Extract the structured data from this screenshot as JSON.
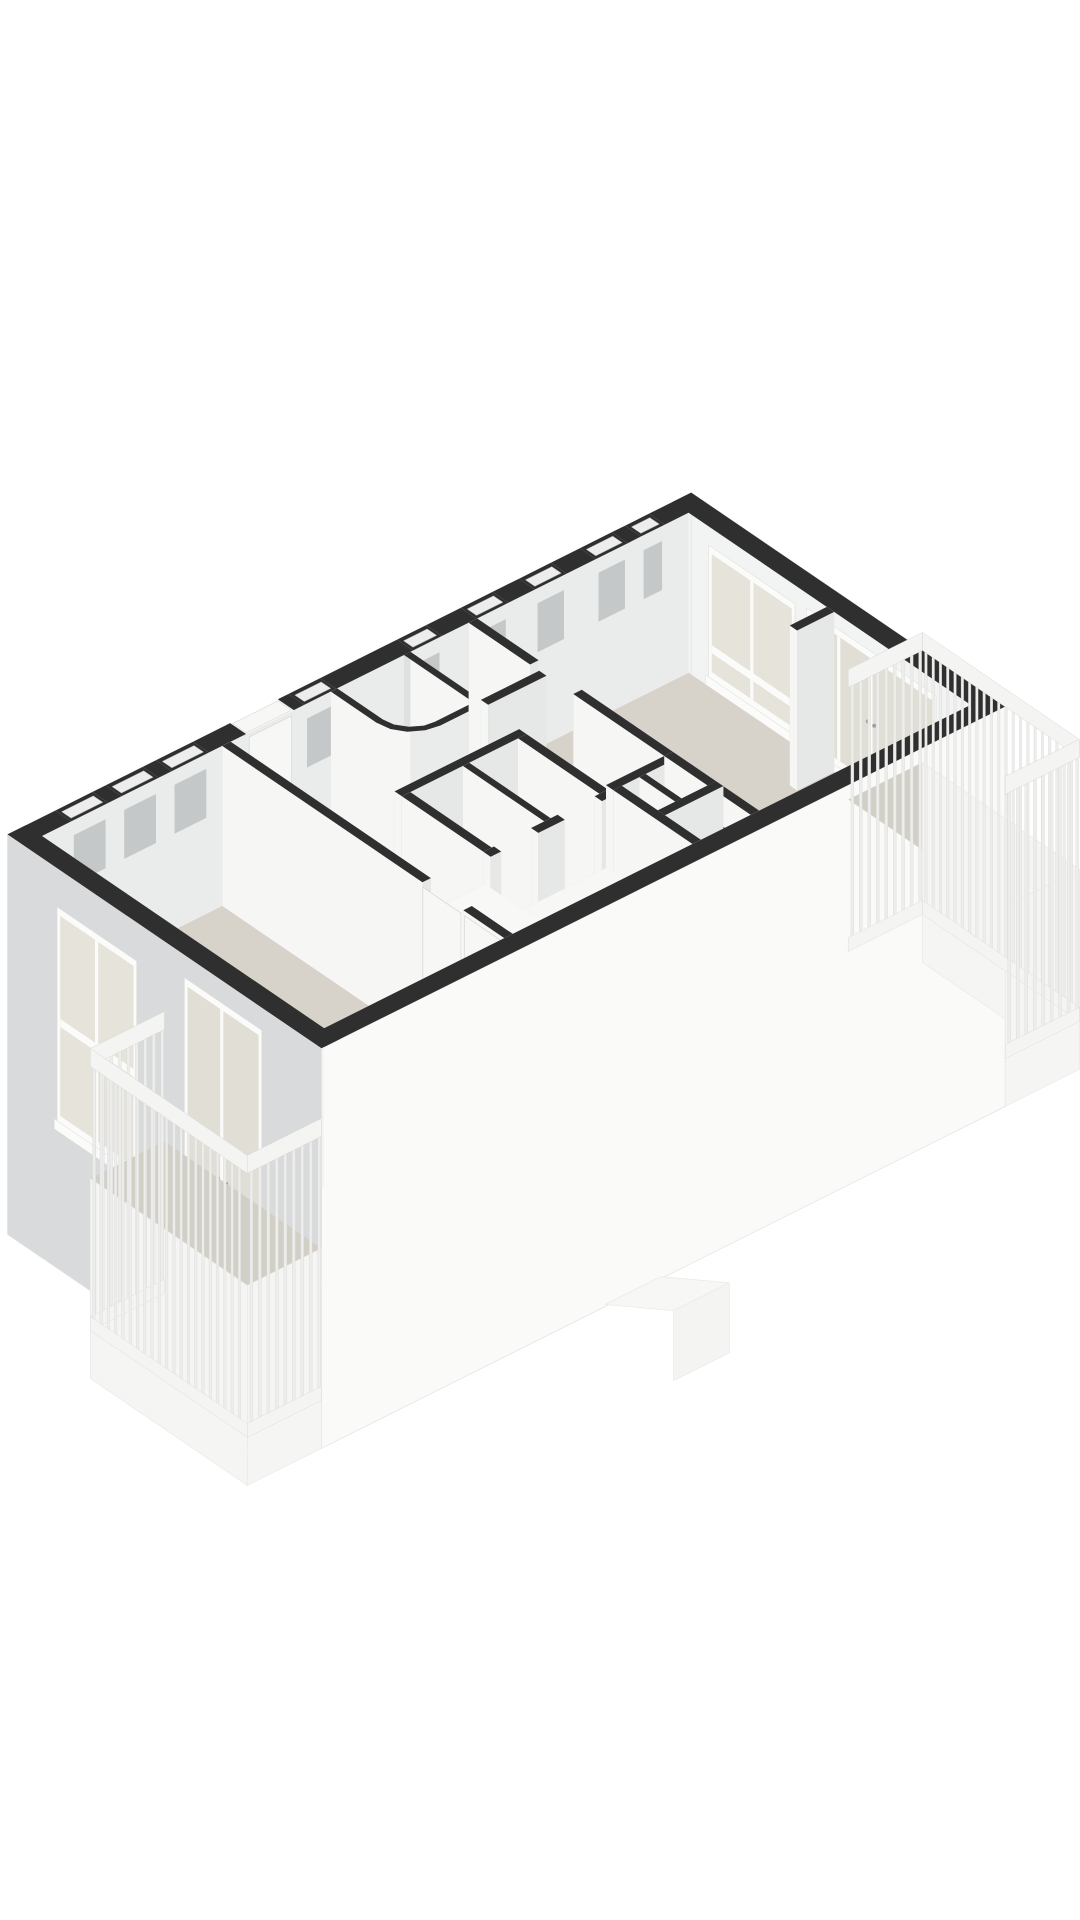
{
  "page": {
    "background": "#ffffff"
  },
  "palette": {
    "wallTop": "#2f2f30",
    "floor": "#d7d3ca",
    "balconyFloor": "#d2cfc7",
    "inMinusU": "#f6f6f5",
    "inPlusU": "#efefee",
    "inPlusV": "#e6e8e7",
    "inMinusV": "#c8cbcc",
    "nwInner": "#eaecec",
    "neInner": "#f1f2f1",
    "seInner": "#c8cbcc",
    "swInner": "#f4f4f3",
    "wcInner": "#dfe1e0",
    "facadeSE": "#fafaf9",
    "facadeSW": "#d8dadb",
    "facadeNE": "#f2f3f3",
    "frame": "#fbfbfa",
    "glass": "#e6e3db",
    "glassDoor": "#e1ded6",
    "slit": "#ecedec",
    "slitEdge": "#98989b",
    "recess": "#c5c8c9",
    "doorPanel": "#f7f7f6",
    "doorEdge": "#d6d6d4",
    "handle": "#9ea2a4",
    "seam": "#dadad8",
    "fixture": "#f5f5f3",
    "fixtureEdge": "#bfbfbc",
    "fixtureInner": "#ebebe9",
    "fixtureShadow": "#d2d2cf",
    "railTop": "#f4f4f3",
    "railSlat": "#ededec",
    "railEdge": "#d8d8d6",
    "fascia": "#f5f5f4",
    "ghost": "#f7f7f6",
    "ghostEdge": "#ebebe9"
  },
  "proj": {
    "au": [
      53,
      -26.5
    ],
    "av": [
      45.5,
      31
    ],
    "origin": [
      42,
      836
    ],
    "floor_z": 160,
    "facade_z": 400
  },
  "scene": [
    {
      "name": "nw-exterior-wall",
      "t": "xwall",
      "dir": "u",
      "at": 0,
      "sign": -1,
      "th": 0.35,
      "s": [
        -0.35,
        12.55
      ],
      "inS": [
        0,
        12.2
      ],
      "hIn": 160,
      "fIn": "nwInner",
      "hOut": 0,
      "gaps": [
        {
          "k": "slit",
          "s": [
            0.55,
            1.25
          ]
        },
        {
          "k": "slit",
          "s": [
            1.5,
            2.2
          ]
        },
        {
          "k": "slit",
          "s": [
            2.45,
            3.15
          ]
        },
        {
          "k": "door",
          "s": [
            3.85,
            4.75
          ]
        },
        {
          "k": "slit",
          "s": [
            4.95,
            5.55
          ]
        },
        {
          "k": "slit",
          "s": [
            7.0,
            7.55
          ]
        },
        {
          "k": "slit",
          "s": [
            8.2,
            8.8
          ]
        },
        {
          "k": "slit",
          "s": [
            9.3,
            9.9
          ]
        },
        {
          "k": "slit",
          "s": [
            10.45,
            11.05
          ]
        },
        {
          "k": "slit",
          "s": [
            11.3,
            11.75
          ]
        }
      ]
    },
    {
      "name": "nw-clerestory-recesses",
      "t": "recesses",
      "list": [
        [
          0.55,
          1.25
        ],
        [
          1.5,
          2.2
        ],
        [
          2.45,
          3.15
        ],
        [
          4.95,
          5.55
        ],
        [
          7.0,
          7.55
        ],
        [
          8.2,
          8.8
        ],
        [
          9.3,
          9.9
        ],
        [
          10.45,
          11.05
        ],
        [
          11.3,
          11.75
        ]
      ],
      "z": [
        15,
        64
      ]
    },
    {
      "name": "entrance-door-panel",
      "t": "face",
      "dir": "u",
      "at": 0.01,
      "s": [
        3.9,
        4.7
      ],
      "z": [
        4,
        158
      ],
      "fill": "doorPanel",
      "stroke": "doorEdge",
      "sw": 0.7
    },
    {
      "name": "entrance-door-handle",
      "t": "dot",
      "u": 4.56,
      "v": 0.01,
      "z": 85
    },
    {
      "name": "ne-exterior-wall",
      "t": "xwall",
      "dir": "v",
      "at": 12.2,
      "sign": 1,
      "th": 0.35,
      "s": [
        -0.35,
        6.55
      ],
      "inS": [
        0,
        6.2
      ],
      "hIn": 160,
      "fIn": "neInner",
      "hOut": 400,
      "fOut": "facadeNE"
    },
    {
      "name": "living-window",
      "t": "win",
      "dir": "v",
      "at": 12.19,
      "s1": 0.45,
      "s2": 2.35,
      "z1": 18,
      "z2": 150,
      "mull": [
        1.4
      ],
      "rails": [
        [
          116,
          124
        ]
      ],
      "sill": [
        150,
        160
      ]
    },
    {
      "name": "living-balcony-doors",
      "t": "win",
      "dir": "v",
      "at": 12.19,
      "s1": 2.6,
      "s2": 5.45,
      "z1": 14,
      "z2": 152,
      "glass": "glassDoor",
      "mull": [
        3.31,
        4.02,
        4.73
      ],
      "handles": [
        [
          3.95,
          86
        ],
        [
          4.09,
          86
        ]
      ],
      "sill": [
        152,
        160
      ]
    },
    {
      "name": "apartment-floor",
      "t": "flat",
      "pts": [
        [
          0,
          0
        ],
        [
          12.2,
          0
        ],
        [
          12.2,
          6.2
        ],
        [
          0,
          6.2
        ]
      ],
      "z": 160,
      "fill": "floor"
    },
    {
      "name": "wc-basin-shadow",
      "t": "ell",
      "u": 6.38,
      "v": 0.54,
      "z": 156,
      "r": 0.19,
      "fill": "fixtureShadow"
    },
    {
      "name": "wc-basin",
      "t": "ell",
      "u": 6.36,
      "v": 0.5,
      "z": 148,
      "r": 0.16,
      "fill": "fixture",
      "stroke": "fixtureEdge",
      "sw": 0.8
    },
    {
      "name": "wc-basin-tap",
      "t": "seg",
      "a": [
        6.5,
        0.3,
        118
      ],
      "b": [
        6.4,
        0.44,
        126
      ],
      "w": 1.6,
      "col": "#b4b8ba"
    },
    {
      "name": "wc-inner-walls",
      "t": "ribbon",
      "pts": [
        [
          5.57,
          0
        ],
        [
          5.57,
          1.0
        ],
        [
          5.61,
          1.2
        ],
        [
          5.74,
          1.38
        ],
        [
          5.92,
          1.5
        ],
        [
          6.1,
          1.53
        ],
        [
          6.83,
          1.53
        ],
        [
          6.83,
          0
        ]
      ],
      "z": [
        0,
        160
      ],
      "fill": "wcInner"
    },
    {
      "name": "wc-outer-walls",
      "t": "ribbon",
      "pts": [
        [
          5.45,
          0
        ],
        [
          5.45,
          1.0
        ],
        [
          5.5,
          1.25
        ],
        [
          5.64,
          1.46
        ],
        [
          5.86,
          1.6
        ],
        [
          6.1,
          1.65
        ],
        [
          6.95,
          1.65
        ],
        [
          6.95,
          0
        ]
      ],
      "z": [
        0,
        160
      ],
      "fill": "inMinusU"
    },
    {
      "name": "wc-wall-top",
      "t": "ribbonTop",
      "outer": [
        [
          5.45,
          0
        ],
        [
          5.45,
          1.0
        ],
        [
          5.5,
          1.25
        ],
        [
          5.64,
          1.46
        ],
        [
          5.86,
          1.6
        ],
        [
          6.1,
          1.65
        ],
        [
          6.95,
          1.65
        ],
        [
          6.95,
          0
        ]
      ],
      "inner": [
        [
          5.57,
          0
        ],
        [
          5.57,
          1.0
        ],
        [
          5.61,
          1.2
        ],
        [
          5.74,
          1.38
        ],
        [
          5.92,
          1.5
        ],
        [
          6.1,
          1.53
        ],
        [
          6.83,
          1.53
        ],
        [
          6.83,
          0
        ]
      ],
      "fill": "wallTop"
    },
    {
      "name": "living-wall-upper",
      "t": "box",
      "u1": 8.05,
      "u2": 8.21,
      "v1": 0,
      "v2": 1.35
    },
    {
      "name": "living-wall-mid",
      "t": "box",
      "u1": 8.05,
      "u2": 8.21,
      "v1": 2.3,
      "v2": 4.3
    },
    {
      "name": "corridor-north-wall",
      "t": "box",
      "u1": 6.95,
      "u2": 8.05,
      "v1": 1.55,
      "v2": 1.71
    },
    {
      "name": "bathroom-back-wall",
      "t": "box",
      "u1": 4.55,
      "u2": 6.9,
      "v1": 2.45,
      "v2": 2.61
    },
    {
      "name": "bathroom-right-wall",
      "t": "box",
      "u1": 6.74,
      "u2": 6.9,
      "v1": 2.61,
      "v2": 4.4
    },
    {
      "name": "toilet2-shadow",
      "t": "ell",
      "u": 6.32,
      "v": 3.26,
      "z": 156,
      "r": 0.25,
      "fill": "fixtureShadow"
    },
    {
      "name": "toilet2-cistern",
      "t": "box",
      "u1": 6.14,
      "u2": 6.46,
      "v1": 2.62,
      "v2": 2.86,
      "z1": 100,
      "ftop": "#f0f0ee",
      "fmu": "#fbfbfa",
      "fpv": "#ededeb"
    },
    {
      "name": "toilet2-bowl",
      "t": "ell",
      "u": 6.3,
      "v": 3.2,
      "z": 146,
      "r": 0.21,
      "fill": "fixture",
      "stroke": "fixtureEdge",
      "sw": 0.8
    },
    {
      "name": "toilet2-seat",
      "t": "ell",
      "u": 6.28,
      "v": 3.16,
      "z": 144,
      "r": 0.12,
      "fill": "fixtureInner",
      "stroke": "#d6d6d3",
      "sw": 0.5
    },
    {
      "name": "bathroom-partition",
      "t": "box",
      "u1": 5.7,
      "u2": 5.82,
      "v1": 2.61,
      "v2": 4.4
    },
    {
      "name": "toilet1-shadow",
      "t": "ell",
      "u": 5.18,
      "v": 3.26,
      "z": 156,
      "r": 0.25,
      "fill": "fixtureShadow"
    },
    {
      "name": "toilet1-cistern",
      "t": "box",
      "u1": 4.98,
      "u2": 5.3,
      "v1": 2.62,
      "v2": 2.86,
      "z1": 100,
      "ftop": "#f0f0ee",
      "fmu": "#fbfbfa",
      "fpv": "#ededeb"
    },
    {
      "name": "toilet1-bowl",
      "t": "ell",
      "u": 5.16,
      "v": 3.2,
      "z": 146,
      "r": 0.21,
      "fill": "fixture",
      "stroke": "fixtureEdge",
      "sw": 0.8
    },
    {
      "name": "toilet1-seat",
      "t": "ell",
      "u": 5.14,
      "v": 3.16,
      "z": 144,
      "r": 0.12,
      "fill": "fixtureInner",
      "stroke": "#d6d6d3",
      "sw": 0.5
    },
    {
      "name": "bathroom-left-wall",
      "t": "box",
      "u1": 4.55,
      "u2": 4.71,
      "v1": 2.61,
      "v2": 4.4
    },
    {
      "name": "bathroom-front-wall-a",
      "t": "box",
      "u1": 4.55,
      "u2": 4.75,
      "v1": 4.4,
      "v2": 4.56
    },
    {
      "name": "bathroom-front-wall-b",
      "t": "box",
      "u1": 5.45,
      "u2": 5.95,
      "v1": 4.4,
      "v2": 4.56
    },
    {
      "name": "bathroom-front-wall-c",
      "t": "box",
      "u1": 6.65,
      "u2": 6.9,
      "v1": 4.4,
      "v2": 4.56
    },
    {
      "name": "storage-back-wall",
      "t": "box",
      "u1": 6.95,
      "u2": 8.05,
      "v1": 4.3,
      "v2": 4.46
    },
    {
      "name": "storage-right-wall",
      "t": "box",
      "u1": 8.05,
      "u2": 8.21,
      "v1": 4.3,
      "v2": 6.2
    },
    {
      "name": "storage-mid-wall-u",
      "t": "box",
      "u1": 7.44,
      "u2": 7.56,
      "v1": 4.46,
      "v2": 6.2
    },
    {
      "name": "storage-mid-wall-v",
      "t": "box",
      "u1": 6.95,
      "u2": 8.21,
      "v1": 5.25,
      "v2": 5.41
    },
    {
      "name": "storage-left-wall",
      "t": "box",
      "u1": 6.95,
      "u2": 7.11,
      "v1": 4.46,
      "v2": 6.2
    },
    {
      "name": "hall-low-cabinet",
      "t": "box",
      "u1": 4.6,
      "u2": 6.8,
      "v1": 4.5,
      "v2": 5.08,
      "z1": 72,
      "ftop": "#f7f7f6",
      "fmu": "#f4f4f2",
      "fpv": "#f1f1ef",
      "seamsV": [
        5.15,
        5.7,
        6.25
      ]
    },
    {
      "name": "wardrobe",
      "t": "box",
      "u1": 3.62,
      "u2": 4.5,
      "v1": 4.5,
      "v2": 6.05,
      "z1": 28,
      "ftop": "#f8f8f7",
      "fmu": "#fafaf8",
      "fpv": "#ebedec",
      "seamsU": [
        5.27
      ],
      "handles": [
        {
          "f": "mu",
          "s": 5.2,
          "z": 88
        },
        {
          "f": "mu",
          "s": 5.35,
          "z": 88
        }
      ]
    },
    {
      "name": "bedroom-wall-upper",
      "t": "box",
      "u1": 3.4,
      "u2": 3.56,
      "v1": 0,
      "v2": 4.4
    },
    {
      "name": "bedroom-door",
      "t": "face",
      "dir": "v",
      "at": 3.39,
      "s": [
        4.42,
        5.26
      ],
      "z": [
        4,
        158
      ],
      "fill": "doorPanel",
      "stroke": "doorEdge",
      "sw": 0.7
    },
    {
      "name": "bedroom-door-handle",
      "t": "dot",
      "u": 3.39,
      "v": 5.12,
      "z": 88
    },
    {
      "name": "bedroom-wall-lower",
      "t": "box",
      "u1": 3.4,
      "u2": 3.56,
      "v1": 5.3,
      "v2": 6.2
    },
    {
      "name": "closet-door",
      "t": "face",
      "dir": "v",
      "at": 3.39,
      "s": [
        5.34,
        6.14
      ],
      "z": [
        4,
        158
      ],
      "fill": "doorPanel",
      "stroke": "doorEdge",
      "sw": 0.7
    },
    {
      "name": "closet-door-handle",
      "t": "dot",
      "u": 3.39,
      "v": 5.48,
      "z": 88
    },
    {
      "name": "living-stub-wall",
      "t": "box",
      "u1": 11.5,
      "u2": 12.2,
      "v1": 3.04,
      "v2": 3.2
    },
    {
      "name": "se-exterior-wall",
      "t": "xwall",
      "dir": "u",
      "at": 6.2,
      "sign": 1,
      "th": 0.35,
      "s": [
        -0.35,
        12.55
      ],
      "inS": [
        0,
        12.2
      ],
      "hIn": 160,
      "fIn": "seInner",
      "hOut": 400,
      "fOut": "facadeSE"
    },
    {
      "name": "sw-exterior-wall",
      "t": "xwall",
      "dir": "v",
      "at": 0,
      "sign": -1,
      "th": 0.35,
      "s": [
        -0.35,
        6.55
      ],
      "inS": [
        0,
        6.2
      ],
      "hIn": 160,
      "fIn": "swInner",
      "hOut": 400,
      "fOut": "facadeSW"
    },
    {
      "name": "bedroom-window",
      "t": "win",
      "dir": "v",
      "at": -0.36,
      "s1": 0.75,
      "s2": 2.5,
      "z1": 38,
      "z2": 252,
      "mull": [
        1.62
      ],
      "rails": [
        [
          148,
          156
        ]
      ],
      "sill": [
        252,
        262
      ]
    },
    {
      "name": "bedroom-balcony-doors",
      "t": "win",
      "dir": "v",
      "at": -0.36,
      "s1": 3.55,
      "s2": 5.25,
      "z1": 22,
      "z2": 385,
      "glass": "glassDoor",
      "mull": [
        4.37
      ],
      "handles": [
        [
          4.28,
          200
        ],
        [
          4.47,
          200
        ]
      ],
      "sill": [
        370,
        385
      ]
    },
    {
      "name": "lower-level-ghost-top",
      "t": "p3",
      "pts": [
        [
          5.0,
          6.55,
          398
        ],
        [
          6.05,
          6.55,
          398
        ],
        [
          6.7,
          7.3,
          398
        ],
        [
          5.65,
          7.3,
          398
        ]
      ],
      "fill": "ghost",
      "stroke": "ghostEdge",
      "sw": 0.8
    },
    {
      "name": "lower-level-ghost-face",
      "t": "p3",
      "pts": [
        [
          5.65,
          7.3,
          398
        ],
        [
          6.7,
          7.3,
          398
        ],
        [
          6.7,
          7.3,
          468
        ],
        [
          5.65,
          7.3,
          468
        ]
      ],
      "fill": "#f4f4f3",
      "stroke": "ghostEdge",
      "sw": 0.8
    },
    {
      "name": "south-balcony-floor",
      "t": "flat",
      "pts": [
        [
          -1.75,
          3.1
        ],
        [
          -0.35,
          3.1
        ],
        [
          -0.35,
          6.55
        ],
        [
          -1.75,
          6.55
        ]
      ],
      "z": 200,
      "fill": "balconyFloor"
    },
    {
      "name": "south-balcony-fascia-sw",
      "t": "face",
      "dir": "v",
      "at": -1.75,
      "s": [
        3.1,
        6.55
      ],
      "z": [
        200,
        400
      ],
      "fill": "fascia",
      "stroke": "#e7e7e5",
      "sw": 0.6
    },
    {
      "name": "south-balcony-fascia-se",
      "t": "face",
      "dir": "u",
      "at": 6.55,
      "s": [
        -1.75,
        -0.35
      ],
      "z": [
        200,
        400
      ],
      "fill": "fascia",
      "stroke": "#e7e7e5",
      "sw": 0.6
    },
    {
      "name": "south-balcony-rail-nw",
      "t": "fence",
      "dir": "u",
      "at": 3.1,
      "s1": -1.75,
      "s2": -0.35
    },
    {
      "name": "south-balcony-rail-sw",
      "t": "fence",
      "dir": "v",
      "at": -1.75,
      "s1": 3.1,
      "s2": 6.55
    },
    {
      "name": "south-balcony-rail-se",
      "t": "fence",
      "dir": "u",
      "at": 6.55,
      "s1": -1.75,
      "s2": -0.35
    },
    {
      "name": "east-balcony-floor",
      "t": "flat",
      "pts": [
        [
          12.55,
          3.1
        ],
        [
          13.95,
          3.1
        ],
        [
          13.95,
          6.55
        ],
        [
          12.55,
          6.55
        ]
      ],
      "z": 200,
      "fill": "balconyFloor"
    },
    {
      "name": "east-balcony-fascia-ne",
      "t": "face",
      "dir": "v",
      "at": 13.95,
      "s": [
        3.1,
        6.55
      ],
      "z": [
        200,
        400
      ],
      "fill": "fascia",
      "stroke": "#e7e7e5",
      "sw": 0.6
    },
    {
      "name": "east-balcony-fascia-se",
      "t": "face",
      "dir": "u",
      "at": 6.55,
      "s": [
        12.55,
        13.95
      ],
      "z": [
        200,
        400
      ],
      "fill": "fascia",
      "stroke": "#e7e7e5",
      "sw": 0.6
    },
    {
      "name": "east-balcony-rail-nw",
      "t": "fence",
      "dir": "u",
      "at": 3.1,
      "s1": 12.55,
      "s2": 13.95
    },
    {
      "name": "east-balcony-rail-ne",
      "t": "fence",
      "dir": "v",
      "at": 13.95,
      "s1": 3.1,
      "s2": 6.55
    },
    {
      "name": "east-balcony-rail-se",
      "t": "fence",
      "dir": "u",
      "at": 6.55,
      "s1": 12.55,
      "s2": 13.95
    }
  ]
}
